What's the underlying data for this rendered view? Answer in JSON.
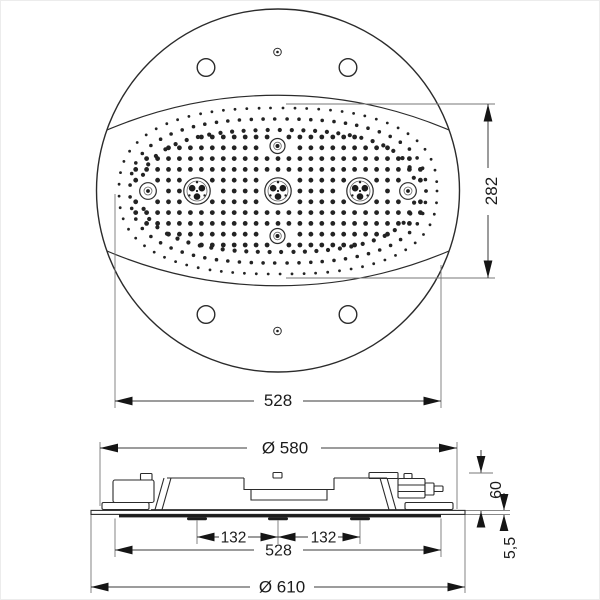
{
  "views": {
    "top": {
      "width_dim": "528",
      "height_dim": "282"
    },
    "side": {
      "diameter_dim": "Ø 580",
      "height_dim": "60",
      "left_spacing_dim": "132",
      "right_spacing_dim": "132",
      "width_dim": "528",
      "plate_thickness_dim": "5,5",
      "overall_diameter_dim": "Ø 610"
    }
  },
  "colors": {
    "line": "#2b2b2b",
    "extension_line": "#777777",
    "dark_face": "#1d1d1d",
    "background": "#ffffff"
  },
  "nozzle_pattern": {
    "center_x": 277,
    "center_y": 190,
    "ring_spacing": 11.4,
    "ring_exponent": 2.5,
    "rings": [
      [
        159,
        83,
        1.4
      ],
      [
        148,
        72,
        1.8
      ],
      [
        137,
        61,
        2.1
      ]
    ],
    "grid_dx": 10.95,
    "grid_dy": 10.8,
    "grid_a": 146,
    "grid_b": 58,
    "grid_exponent": 2.8,
    "grid_dot_r": 2.4,
    "exclusions": [
      [
        196,
        190,
        17
      ],
      [
        277,
        190,
        17
      ],
      [
        359,
        190,
        17
      ],
      [
        147,
        190,
        13
      ],
      [
        407,
        190,
        13
      ],
      [
        276.5,
        145,
        12
      ],
      [
        276.5,
        235,
        12
      ]
    ]
  }
}
